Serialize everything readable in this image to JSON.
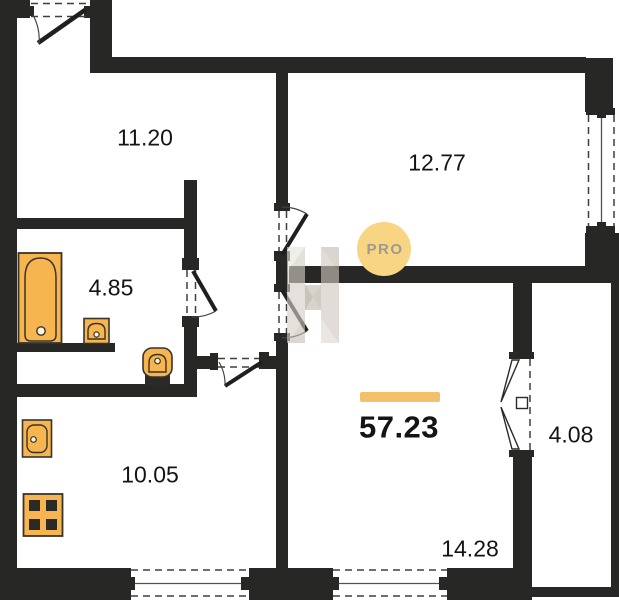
{
  "watermark": {
    "badge_text": "PRO"
  },
  "areas": {
    "entry_hall": "11.20",
    "bedroom": "12.77",
    "bathroom": "4.85",
    "kitchen": "10.05",
    "living_room": "14.28",
    "balcony": "4.08",
    "total": "57.23"
  },
  "colors": {
    "wall": "#272725",
    "fixture": "#f6b54e",
    "fixture_line": "#3a3428",
    "accent_bar": "#f2c169",
    "badge_bg": "#f8d583",
    "badge_text": "#9d9a94",
    "text": "#141414"
  }
}
